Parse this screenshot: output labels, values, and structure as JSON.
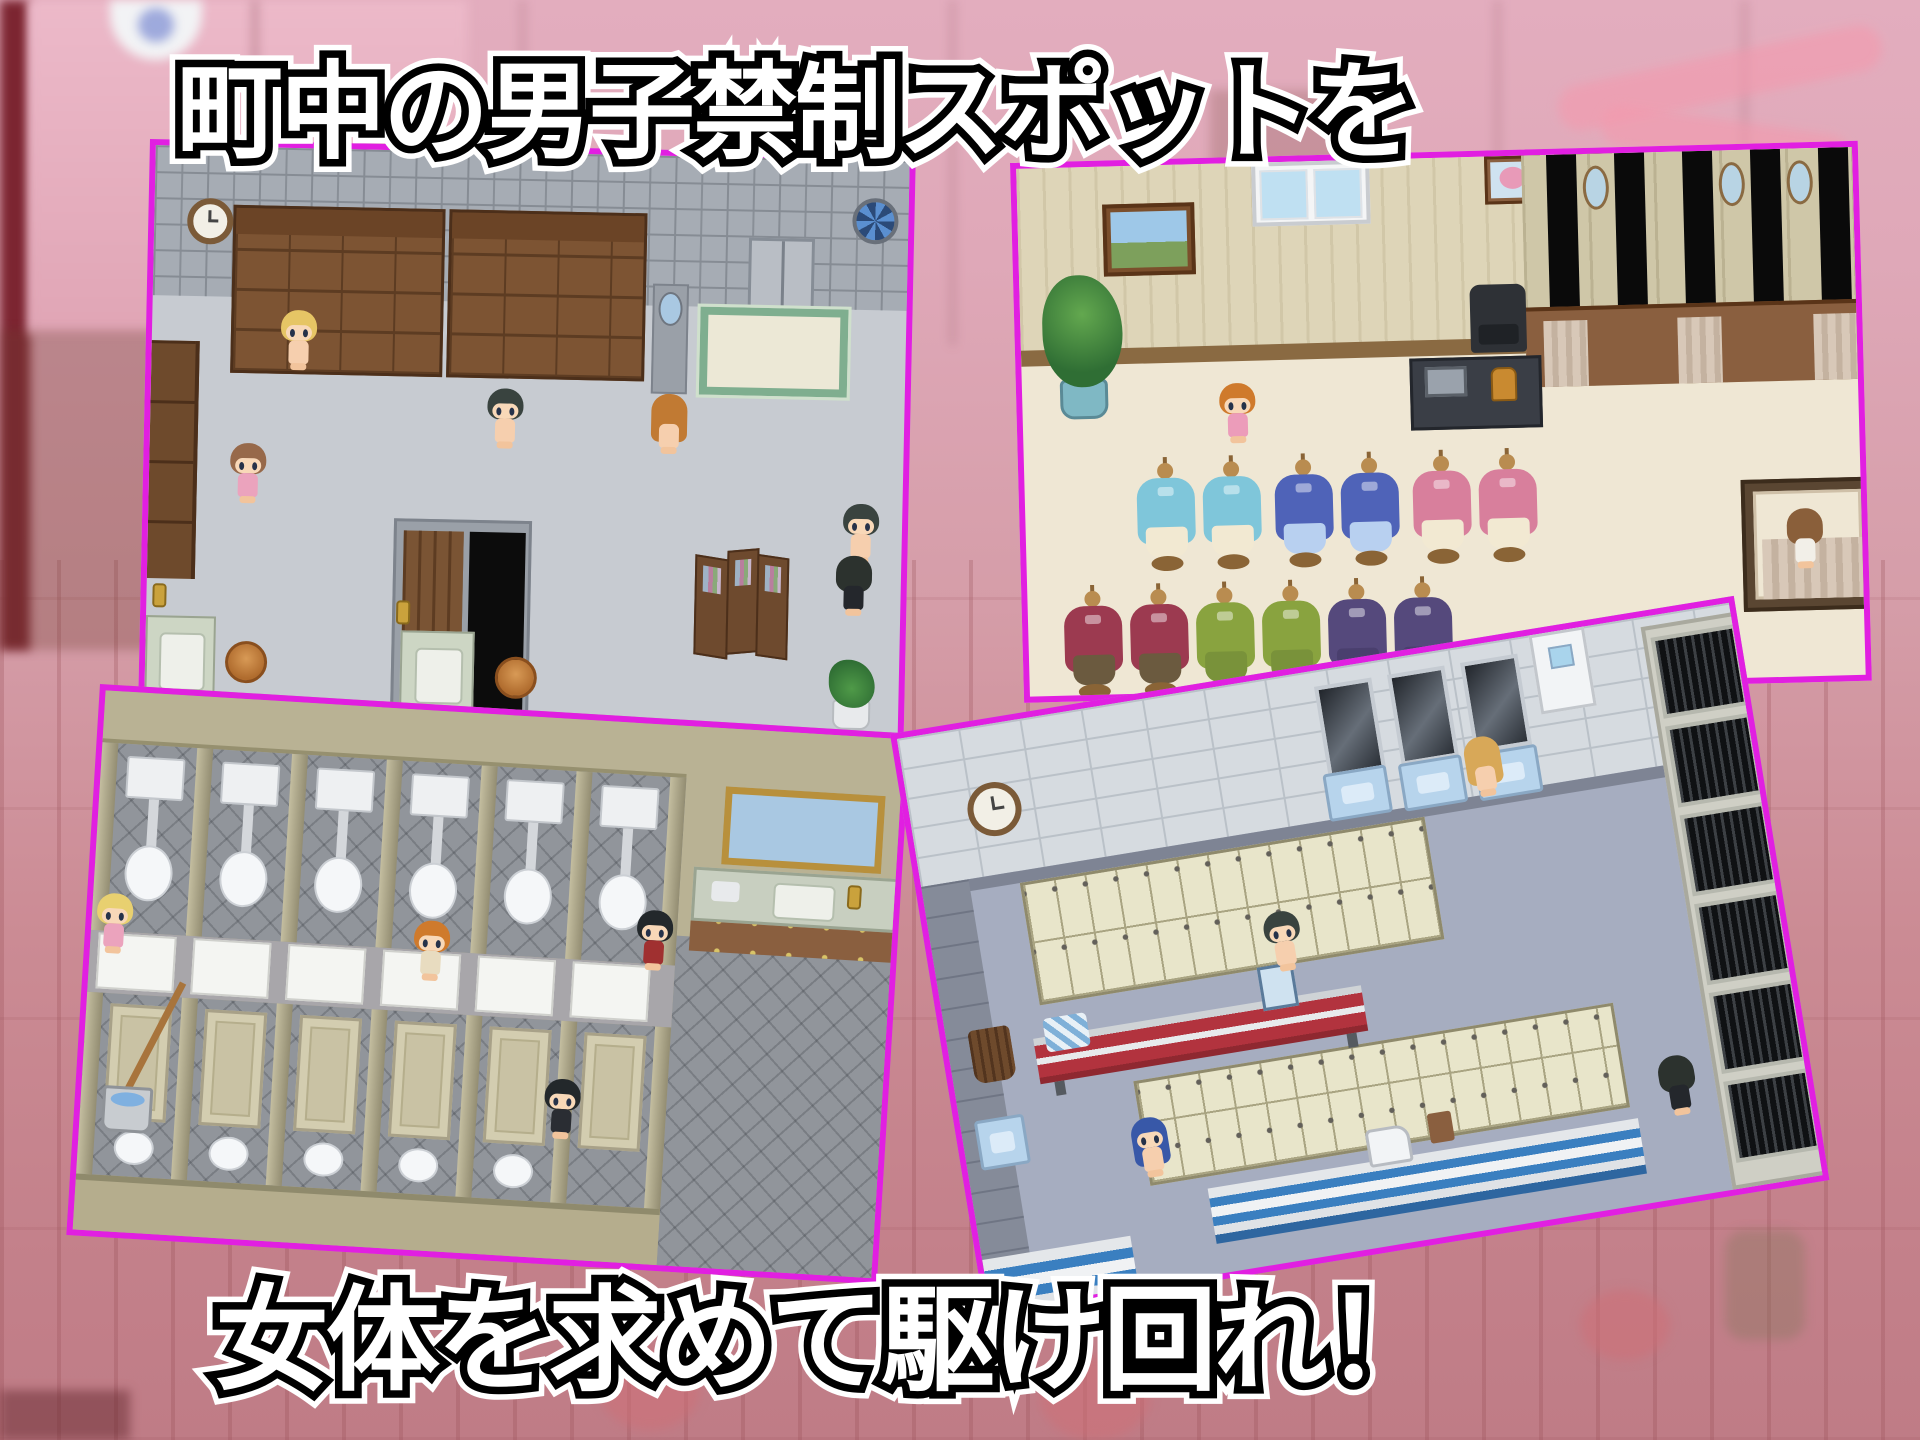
{
  "titles": {
    "top": "町中の男子禁制スポットを",
    "bottom": "女体を求めて駆け回れ！"
  },
  "colors": {
    "panel_border": "#e11fe1",
    "background_top": "#e3adbe",
    "background_bottom": "#bf7c86",
    "title_fill": "#ffffff",
    "title_outline": "#000000"
  },
  "panels": {
    "changing_room": {
      "label": "bathhouse changing room screenshot",
      "characters": [
        {
          "x": 128,
          "y": 162,
          "hair": "#e6c565",
          "outfit": "#f6cfae",
          "facing": "front",
          "long": false
        },
        {
          "x": 336,
          "y": 236,
          "hair": "#39433f",
          "outfit": "#f6cfae",
          "facing": "front",
          "long": false
        },
        {
          "x": 80,
          "y": 296,
          "hair": "#97694a",
          "outfit": "#eba3bd",
          "facing": "front",
          "long": false
        },
        {
          "x": 500,
          "y": 238,
          "hair": "#c17a33",
          "outfit": "#f6cfae",
          "facing": "back",
          "long": true
        },
        {
          "x": 694,
          "y": 344,
          "hair": "#39433f",
          "outfit": "#f6cfae",
          "facing": "front",
          "long": false
        },
        {
          "x": 688,
          "y": 396,
          "hair": "#2c322e",
          "outfit": "#24272c",
          "facing": "back",
          "long": false
        }
      ]
    },
    "boutique": {
      "label": "clothing boutique screenshot",
      "characters": [
        {
          "x": 196,
          "y": 220,
          "hair": "#cf7a2c",
          "outfit": "#ec9cba",
          "facing": "front",
          "long": false
        },
        {
          "x": 760,
          "y": 360,
          "hair": "#8a5f3a",
          "outfit": "#f2efe8",
          "facing": "back",
          "long": false
        }
      ],
      "mannequins": {
        "row1_y": 298,
        "row1": [
          {
            "x": 112,
            "robe": "#7fc6da",
            "skirt": "#f2e9d2"
          },
          {
            "x": 178,
            "robe": "#7fc6da",
            "skirt": "#f2e9d2"
          },
          {
            "x": 250,
            "robe": "#4f63b8",
            "skirt": "#b8d0f0"
          },
          {
            "x": 316,
            "robe": "#4f63b8",
            "skirt": "#b8d0f0"
          },
          {
            "x": 388,
            "robe": "#d87f9c",
            "skirt": "#f2e9d2"
          },
          {
            "x": 454,
            "robe": "#d87f9c",
            "skirt": "#f2e9d2"
          }
        ],
        "row2_y": 424,
        "row2": [
          {
            "x": 36,
            "robe": "#9c3a50",
            "skirt": "#6b5a3f"
          },
          {
            "x": 102,
            "robe": "#9c3a50",
            "skirt": "#6b5a3f"
          },
          {
            "x": 168,
            "robe": "#89a33f",
            "skirt": "#79923a"
          },
          {
            "x": 234,
            "robe": "#89a33f",
            "skirt": "#79923a"
          },
          {
            "x": 300,
            "robe": "#55497c",
            "skirt": "#4a3f6e"
          },
          {
            "x": 366,
            "robe": "#55497c",
            "skirt": "#4a3f6e"
          }
        ]
      }
    },
    "toilets": {
      "label": "public toilet screenshot",
      "characters": [
        {
          "x": 4,
          "y": 202,
          "hair": "#e8d070",
          "outfit": "#eba3bd",
          "facing": "front",
          "long": false
        },
        {
          "x": 322,
          "y": 210,
          "hair": "#cf7a2c",
          "outfit": "#e8dcc0",
          "facing": "front",
          "long": false
        },
        {
          "x": 544,
          "y": 186,
          "hair": "#23282b",
          "outfit": "#a03030",
          "facing": "front",
          "long": false
        },
        {
          "x": 462,
          "y": 360,
          "hair": "#23282b",
          "outfit": "#2a2d33",
          "facing": "front",
          "long": false
        }
      ]
    },
    "locker_room": {
      "label": "gym locker room screenshot",
      "characters": [
        {
          "x": 556,
          "y": 92,
          "hair": "#d8a858",
          "outfit": "#f6cfae",
          "facing": "back",
          "long": true
        },
        {
          "x": 330,
          "y": 232,
          "hair": "#39433f",
          "outfit": "#f6cfae",
          "facing": "front",
          "long": false
        },
        {
          "x": 166,
          "y": 414,
          "hair": "#3858a8",
          "outfit": "#f6cfae",
          "facing": "front",
          "long": true
        },
        {
          "x": 696,
          "y": 438,
          "hair": "#2c322e",
          "outfit": "#24272c",
          "facing": "back",
          "long": false
        }
      ]
    }
  }
}
